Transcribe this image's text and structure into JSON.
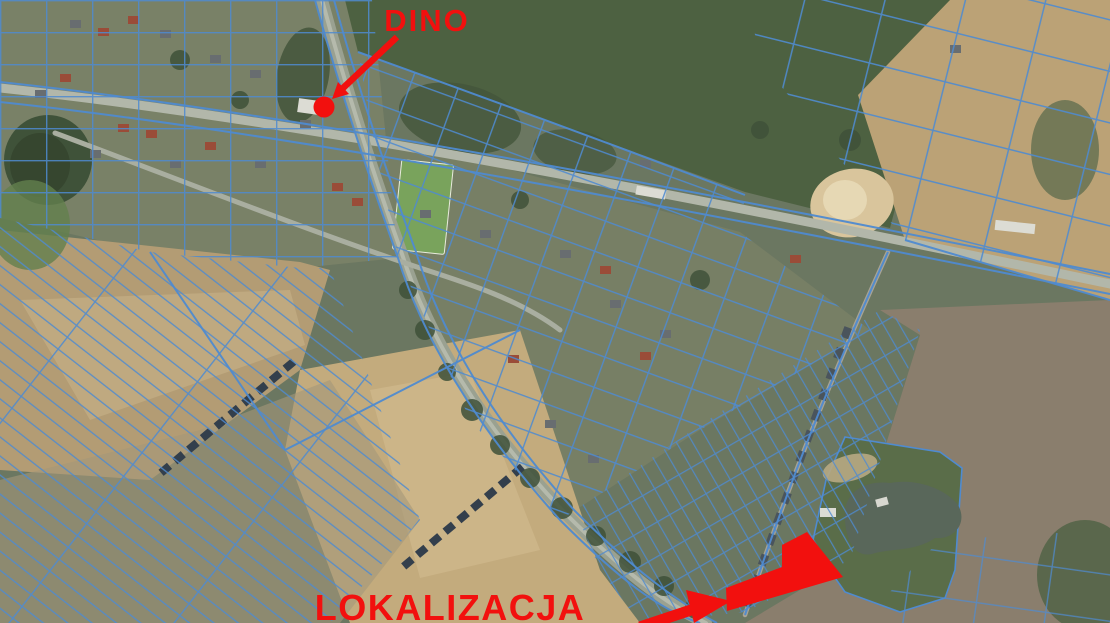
{
  "map": {
    "description": "Aerial orthophoto with blue cadastral parcel overlay and red site annotations",
    "annotations": {
      "dino": {
        "label": "DINO",
        "marker": "red-dot-marker"
      },
      "site": {
        "label": "LOKALIZACJA",
        "marker": "red-area-highlight"
      }
    },
    "colors": {
      "annotation_red": "#f2100e",
      "parcel_line_blue": "#4f8bd0",
      "road_gray": "#b2b7aa",
      "field_green": "#4d6141",
      "field_tan": "#bba276",
      "field_brown": "#8a7e6d",
      "pond_dark_green": "#3f5239",
      "lake_gray_green": "#59675a"
    }
  }
}
